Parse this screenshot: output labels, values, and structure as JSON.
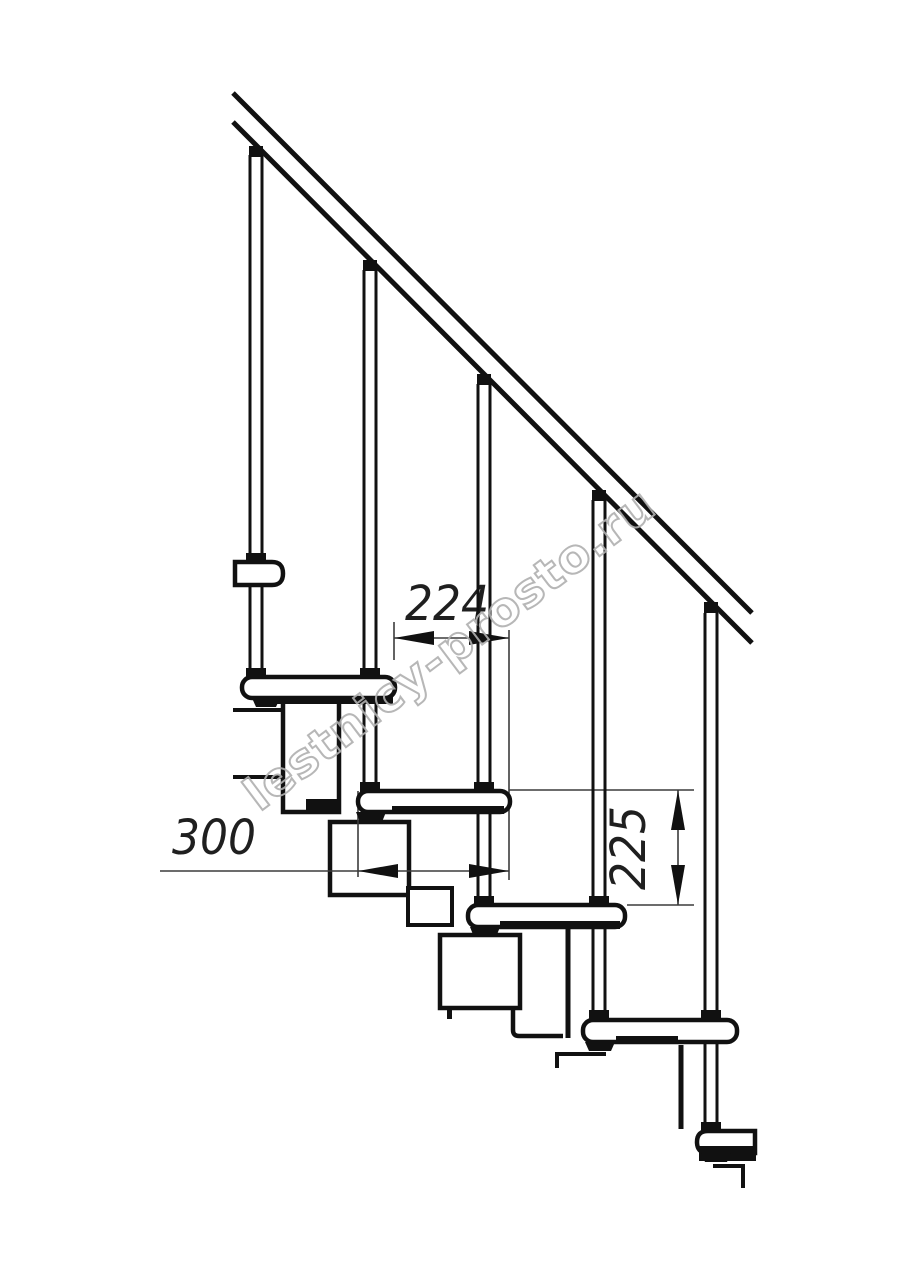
{
  "page": {
    "background": "#ffffff",
    "ink": "#111111"
  },
  "diagram": {
    "kind": "technical-line-drawing",
    "subject": "modular staircase side elevation with handrail, balusters, treads and zigzag module spine",
    "treads_visible": 6,
    "balusters_visible": 5,
    "handrail": "single diagonal rail, cut at both ends",
    "line_color": "#111111",
    "thin_line_color": "#3c3c3c"
  },
  "dimensions": {
    "d224": {
      "label": "224",
      "orientation": "horizontal",
      "meaning": "step run between tread front edges"
    },
    "d300": {
      "label": "300",
      "orientation": "horizontal",
      "meaning": "tread depth"
    },
    "d225": {
      "label": "225",
      "orientation": "vertical",
      "meaning": "riser height between treads"
    }
  },
  "watermark": {
    "text": "lestnicy-prosto.ru",
    "color": "#b0b0b0"
  }
}
